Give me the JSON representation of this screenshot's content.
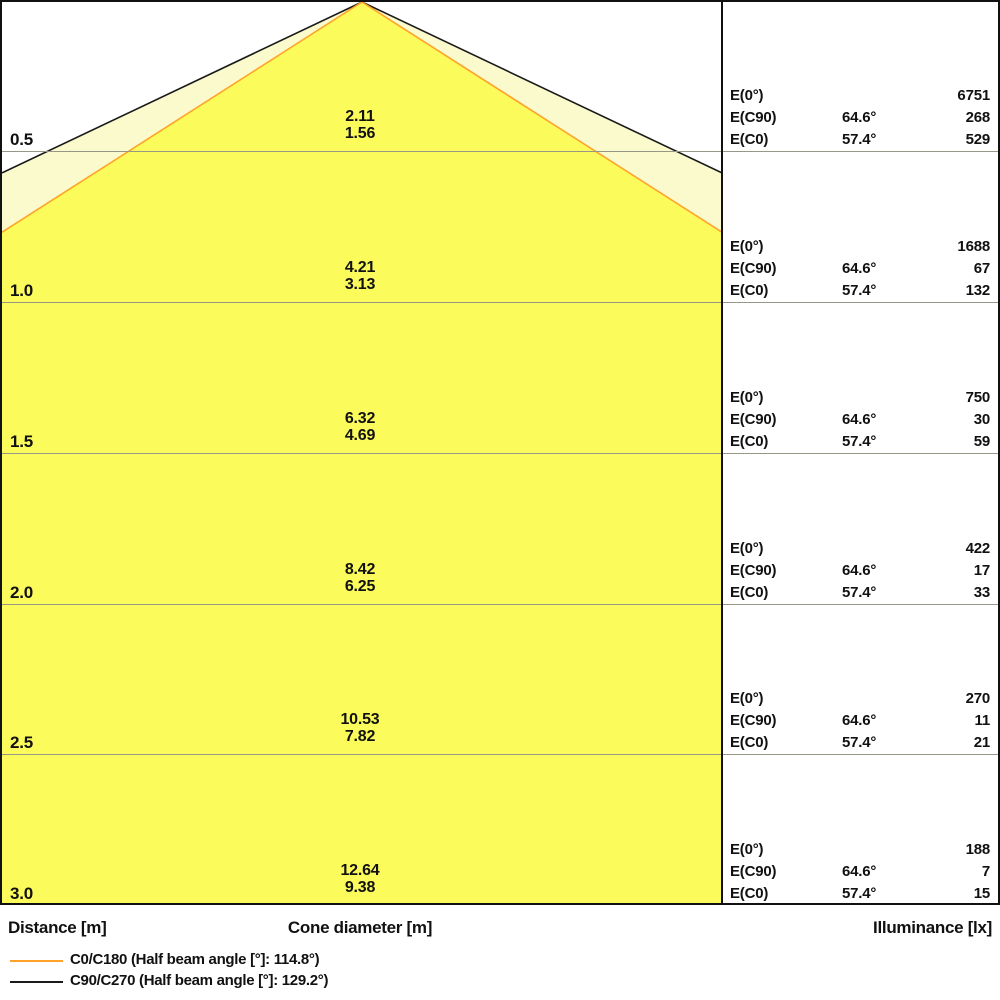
{
  "colors": {
    "cone_bright": "#FBFB5C",
    "cone_pale": "#FAFACC",
    "c0_line": "#FFA428",
    "c90_line": "#1A1A1A",
    "grid": "#979787",
    "border": "#111111"
  },
  "axis": {
    "distance": "Distance [m]",
    "cone_diameter": "Cone diameter [m]",
    "illuminance": "Illuminance [lx]"
  },
  "legend": [
    {
      "label": "C0/C180 (Half beam angle [°]: 114.8°)"
    },
    {
      "label": "C90/C270 (Half beam angle [°]: 129.2°)"
    }
  ],
  "table": {
    "labels": {
      "e0": "E(0°)",
      "ec90": "E(C90)",
      "ec0": "E(C0)",
      "c90_angle": "64.6°",
      "c0_angle": "57.4°"
    },
    "rows": [
      {
        "distance": "0.5",
        "cone_c90": "2.11",
        "cone_c0": "1.56",
        "e0": "6751",
        "ec90": "268",
        "ec0": "529"
      },
      {
        "distance": "1.0",
        "cone_c90": "4.21",
        "cone_c0": "3.13",
        "e0": "1688",
        "ec90": "67",
        "ec0": "132"
      },
      {
        "distance": "1.5",
        "cone_c90": "6.32",
        "cone_c0": "4.69",
        "e0": "750",
        "ec90": "30",
        "ec0": "59"
      },
      {
        "distance": "2.0",
        "cone_c90": "8.42",
        "cone_c0": "6.25",
        "e0": "422",
        "ec90": "17",
        "ec0": "33"
      },
      {
        "distance": "2.5",
        "cone_c90": "10.53",
        "cone_c0": "7.82",
        "e0": "270",
        "ec90": "11",
        "ec0": "21"
      },
      {
        "distance": "3.0",
        "cone_c90": "12.64",
        "cone_c0": "9.38",
        "e0": "188",
        "ec90": "7",
        "ec0": "15"
      }
    ]
  },
  "chart_data": {
    "type": "area",
    "title": "Light cone diagram (luminaire beam spread)",
    "ylabel": "Distance [m]",
    "xlabel": "Cone diameter [m]",
    "value_label": "Illuminance [lx]",
    "distances_m": [
      0.5,
      1.0,
      1.5,
      2.0,
      2.5,
      3.0
    ],
    "series": [
      {
        "name": "C0/C180",
        "half_beam_angle_deg": 114.8,
        "cone_diameter_m": [
          1.56,
          3.13,
          4.69,
          6.25,
          7.82,
          9.38
        ],
        "illuminance_lx": [
          529,
          132,
          59,
          33,
          21,
          15
        ]
      },
      {
        "name": "C90/C270",
        "half_beam_angle_deg": 129.2,
        "cone_diameter_m": [
          2.11,
          4.21,
          6.32,
          8.42,
          10.53,
          12.64
        ],
        "illuminance_lx": [
          268,
          67,
          30,
          17,
          11,
          7
        ]
      }
    ],
    "e0_illuminance_lx": [
      6751,
      1688,
      750,
      422,
      270,
      188
    ],
    "e_angle_labels": {
      "ec90": "64.6°",
      "ec0": "57.4°"
    },
    "axis_ranges": {
      "distance_m": [
        0,
        3.0
      ],
      "half_width_m": [
        -1.2,
        1.2
      ]
    },
    "grid": true,
    "legend_position": "bottom-left"
  }
}
